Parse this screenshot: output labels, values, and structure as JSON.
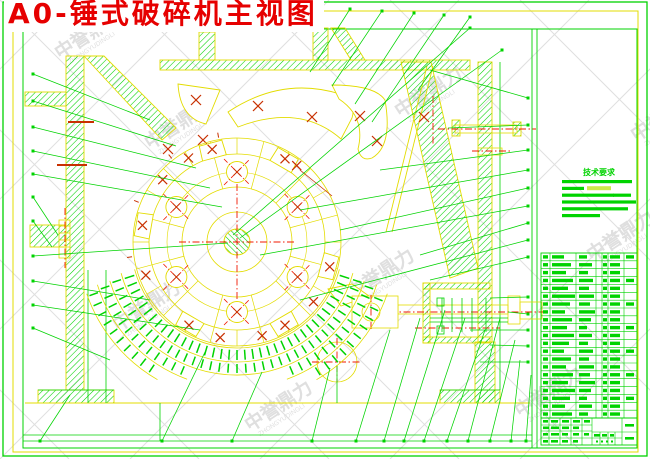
{
  "page": {
    "title": "A0-锤式破碎机主视图"
  },
  "watermark": {
    "text": "中誉鼎力",
    "subtext": "ZHONGYUDINGLI"
  },
  "notes": {
    "title": "技术要求",
    "line_count": 6
  },
  "parts_table": {
    "rows": 21,
    "visible_columns": 7
  },
  "colors": {
    "green": "#00d300",
    "yellow": "#e3dc00",
    "red": "#f01800",
    "dark_red": "#c83000",
    "title_red": "#e60000",
    "watermark": "#dfdfdf",
    "bg": "#ffffff"
  }
}
